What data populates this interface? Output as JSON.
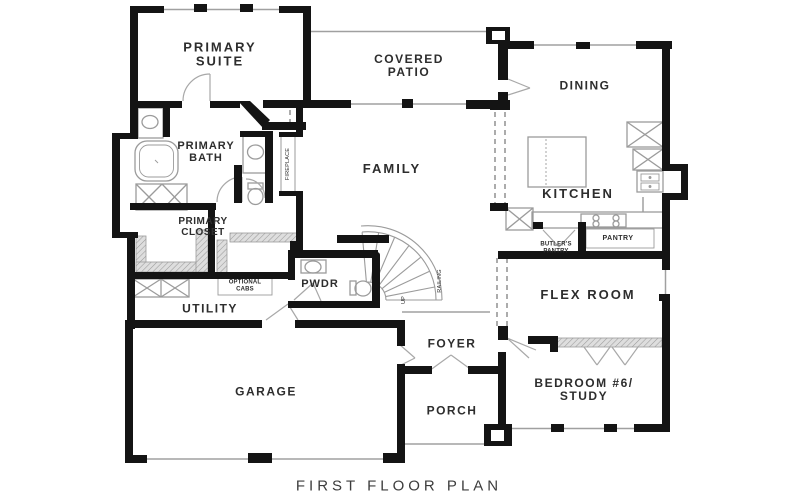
{
  "title": "FIRST FLOOR PLAN",
  "rooms": {
    "primary_suite": "PRIMARY\nSUITE",
    "covered_patio": "COVERED\nPATIO",
    "dining": "DINING",
    "family": "FAMILY",
    "primary_bath": "PRIMARY\nBATH",
    "kitchen": "KITCHEN",
    "primary_closet": "PRIMARY\nCLOSET",
    "butlers_pantry": "BUTLER'S\nPANTRY",
    "pantry": "PANTRY",
    "optional_cabs": "OPTIONAL\nCABS",
    "pwdr": "PWDR",
    "utility": "UTILITY",
    "flex_room": "FLEX ROOM",
    "foyer": "FOYER",
    "bedroom6": "BEDROOM #6/\nSTUDY",
    "garage": "GARAGE",
    "porch": "PORCH",
    "fireplace": "FIREPLACE",
    "railing": "RAILING",
    "up": "UP"
  },
  "colors": {
    "wall": "#141414",
    "thin_line": "#a0a0a0",
    "fixture": "#9b9b9b",
    "hatch": "#dedede"
  }
}
